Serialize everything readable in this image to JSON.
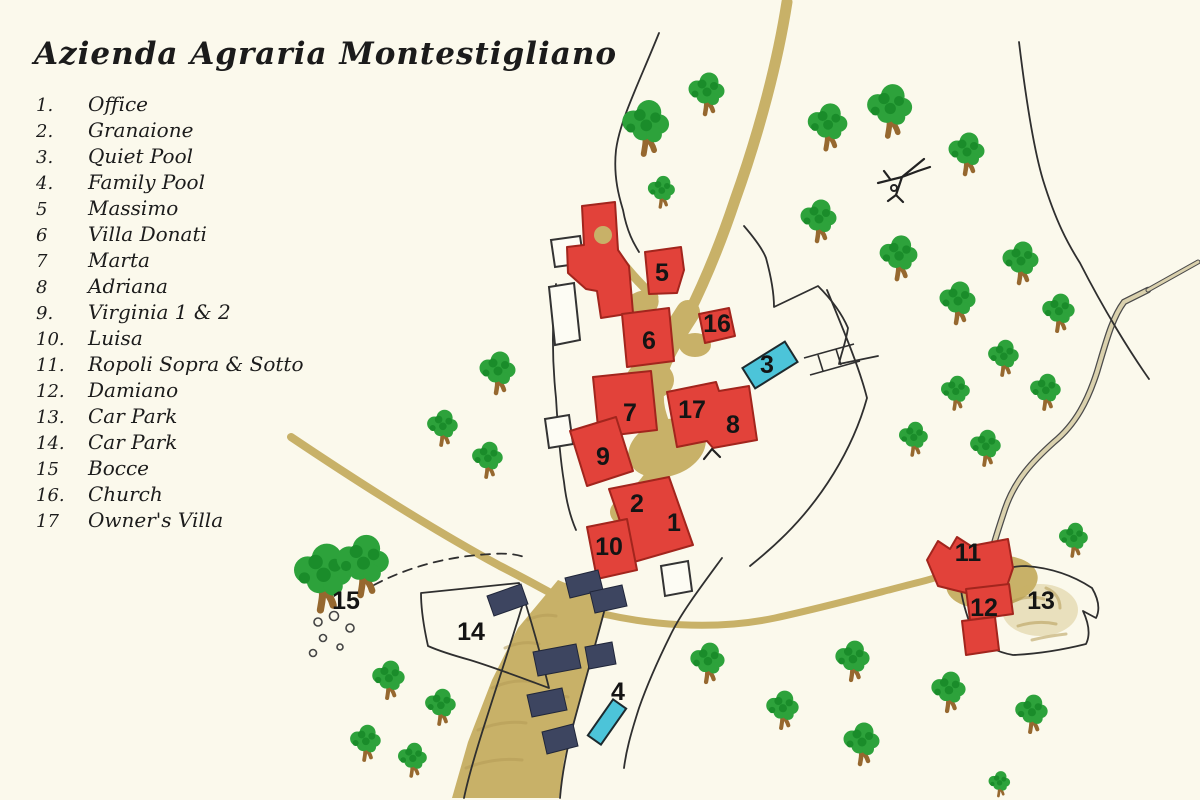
{
  "title": "Azienda Agraria Montestigliano",
  "legend": [
    {
      "num": "1.",
      "label": "Office"
    },
    {
      "num": "2.",
      "label": "Granaione"
    },
    {
      "num": "3.",
      "label": "Quiet Pool"
    },
    {
      "num": "4.",
      "label": "Family Pool"
    },
    {
      "num": "5",
      "label": "Massimo"
    },
    {
      "num": "6",
      "label": "Villa Donati"
    },
    {
      "num": "7",
      "label": "Marta"
    },
    {
      "num": "8",
      "label": "Adriana"
    },
    {
      "num": "9.",
      "label": "Virginia 1 & 2"
    },
    {
      "num": "10.",
      "label": "Luisa"
    },
    {
      "num": "11.",
      "label": "Ropoli Sopra & Sotto"
    },
    {
      "num": "12.",
      "label": "Damiano"
    },
    {
      "num": "13.",
      "label": "Car Park"
    },
    {
      "num": "14.",
      "label": "Car Park"
    },
    {
      "num": "15",
      "label": "Bocce"
    },
    {
      "num": "16.",
      "label": "Church"
    },
    {
      "num": "17",
      "label": "Owner's Villa"
    }
  ],
  "map_labels": [
    {
      "text": "1",
      "x": 674,
      "y": 531
    },
    {
      "text": "2",
      "x": 637,
      "y": 512
    },
    {
      "text": "3",
      "x": 767,
      "y": 373
    },
    {
      "text": "4",
      "x": 618,
      "y": 700
    },
    {
      "text": "5",
      "x": 662,
      "y": 281
    },
    {
      "text": "6",
      "x": 649,
      "y": 349
    },
    {
      "text": "7",
      "x": 630,
      "y": 421
    },
    {
      "text": "8",
      "x": 733,
      "y": 433
    },
    {
      "text": "9",
      "x": 603,
      "y": 465
    },
    {
      "text": "10",
      "x": 609,
      "y": 555
    },
    {
      "text": "11",
      "x": 968,
      "y": 561
    },
    {
      "text": "12",
      "x": 984,
      "y": 616
    },
    {
      "text": "13",
      "x": 1041,
      "y": 609
    },
    {
      "text": "14",
      "x": 471,
      "y": 640
    },
    {
      "text": "15",
      "x": 346,
      "y": 609
    },
    {
      "text": "16",
      "x": 717,
      "y": 332
    },
    {
      "text": "17",
      "x": 692,
      "y": 418
    }
  ],
  "colors": {
    "background": "#fbf9ec",
    "building": "#e2423a",
    "building_outline": "#a2251d",
    "road": "#c8b168",
    "road_dark": "#b49a55",
    "pale_road": "#dad1ad",
    "tree": "#2da23b",
    "tree_dark": "#1a8c2a",
    "trunk": "#96682f",
    "pool": "#4cc4d9",
    "car": "#3d4560",
    "line": "#2f2f2f",
    "text": "#141414"
  },
  "icons": [
    "tree-icon",
    "pool",
    "red-building",
    "white-building",
    "car-icon",
    "bocce-balls-icon",
    "dead-tree-icon",
    "road",
    "field-boundary",
    "fence-icon"
  ]
}
